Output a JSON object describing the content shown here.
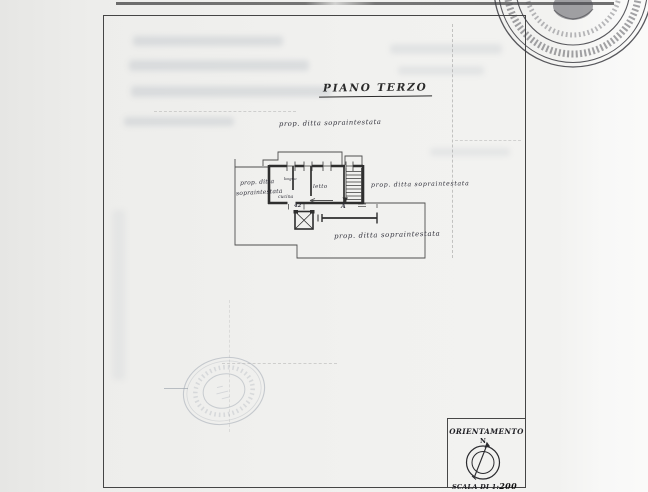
{
  "page": {
    "title": "PIANO TERZO"
  },
  "plan": {
    "annotations": {
      "top": "prop. ditta sopraintestata",
      "left_line1": "prop. ditta",
      "left_line2": "sopraintestata",
      "right": "prop. ditta sopraintestata",
      "bottom": "prop. ditta sopraintestata"
    },
    "rooms": {
      "kitchen": "cucina",
      "bathroom": "bagno",
      "bedroom": "letto"
    },
    "dimensions": {
      "door_width": "42",
      "section_mark": "A"
    }
  },
  "orientation": {
    "label": "ORIENTAMENTO",
    "north": "N",
    "scale_prefix": "SCALA DI 1:",
    "scale_value": "200"
  },
  "icons": {
    "compass": "compass-icon",
    "seal_top_right": "official-seal-icon",
    "stamp_bottom_left": "round-stamp-icon"
  },
  "colors": {
    "paper": "#f1f1ef",
    "ink": "#2e2e2e",
    "frame": "#454545",
    "faint_stamp": "#9aa2ad"
  }
}
